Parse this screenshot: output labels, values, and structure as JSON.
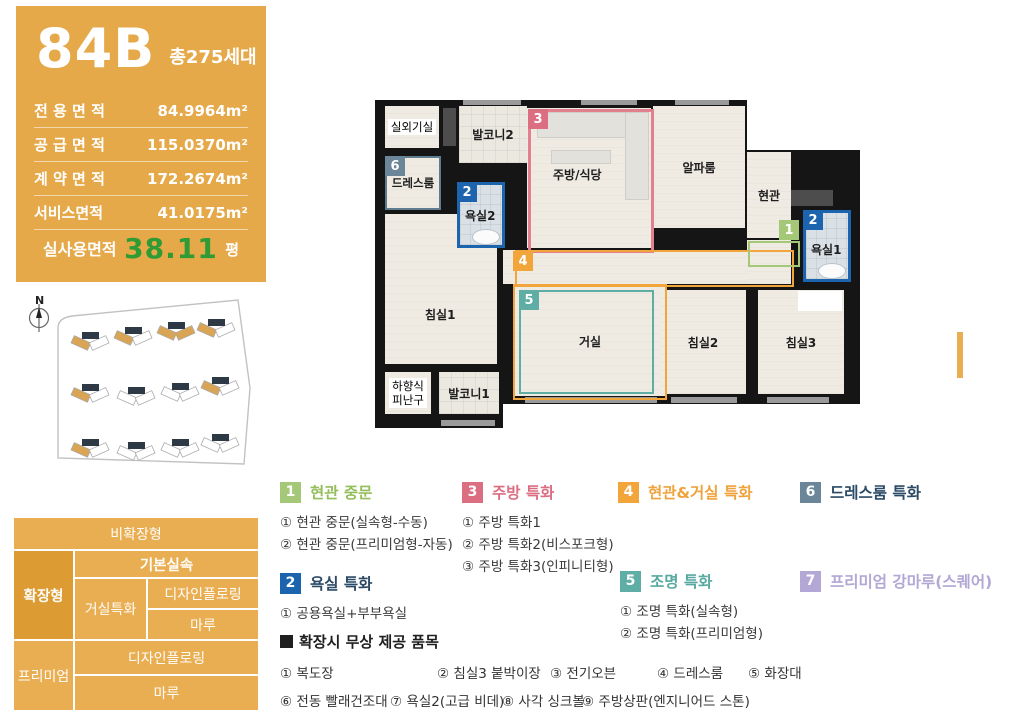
{
  "colors": {
    "panel_orange": "#E5A94A",
    "table_orange": "#EAAE52",
    "table_orange_dark": "#DC9B33",
    "value_green": "#2E9B35",
    "badge_green": "#A5C878",
    "badge_blue": "#1D64AE",
    "badge_pink": "#DC6E81",
    "badge_orange": "#F2A53B",
    "badge_teal": "#5FAEA6",
    "badge_slate": "#6B8698",
    "badge_purple": "#B2A7D5",
    "outline_pink": "#E28090",
    "outline_green": "#A5C878",
    "outline_slate": "#5E7C8E",
    "building_highlight": "#D9A554"
  },
  "unit_panel": {
    "type_code": "84B",
    "total_households": "총275세대",
    "areas": [
      {
        "label": "전 용 면 적",
        "value": "84.9964m²"
      },
      {
        "label": "공 급 면 적",
        "value": "115.0370m²"
      },
      {
        "label": "계 약 면 적",
        "value": "172.2674m²"
      },
      {
        "label": "서비스면적",
        "value": "41.0175m²"
      }
    ],
    "actual_use": {
      "label": "실사용면적",
      "value": "38.11",
      "unit": "평"
    }
  },
  "site_plan": {
    "compass_label": "N"
  },
  "options_table": {
    "non_expanded": "비확장형",
    "expanded": "확장형",
    "basic": "기본실속",
    "living": "거실특화",
    "design_flooring_a": "디자인플로링",
    "maru_a": "마루",
    "premium": "프리미엄",
    "design_flooring_b": "디자인플로링",
    "maru_b": "마루"
  },
  "floorplan": {
    "rooms": {
      "outdoor_unit": "실외기실",
      "balcony2": "발코니2",
      "kitchen": "주방/식당",
      "alpha": "알파룸",
      "entrance": "현관",
      "bath1": "욕실1",
      "dress": "드레스룸",
      "bath2": "욕실2",
      "bed1": "침실1",
      "living": "거실",
      "bed2": "침실2",
      "bed3": "침실3",
      "escape": "하향식\n피난구",
      "balcony1": "발코니1"
    },
    "badges": {
      "entrance_door": "1",
      "bath1": "2",
      "bath2": "2",
      "kitchen": "3",
      "corridor": "4",
      "living": "5",
      "dress": "6"
    }
  },
  "legend": {
    "features": [
      {
        "num": "1",
        "title": "현관 중문",
        "badge_color": "#A5C878",
        "title_color": "#93BE5C",
        "items": [
          "① 현관 중문(실속형-수동)",
          "② 현관 중문(프리미엄형-자동)"
        ]
      },
      {
        "num": "3",
        "title": "주방 특화",
        "badge_color": "#DC6E81",
        "title_color": "#DB6E82",
        "items": [
          "① 주방 특화1",
          "② 주방 특화2(비스포크형)",
          "③ 주방 특화3(인피니티형)"
        ]
      },
      {
        "num": "4",
        "title": "현관&거실 특화",
        "badge_color": "#F2A53B",
        "title_color": "#F0A33C",
        "items": []
      },
      {
        "num": "6",
        "title": "드레스룸 특화",
        "badge_color": "#6B8698",
        "title_color": "#2B4A66",
        "items": []
      },
      {
        "num": "2",
        "title": "욕실 특화",
        "badge_color": "#1D64AE",
        "title_color": "#2B4A66",
        "items": [
          "① 공용욕실+부부욕실"
        ]
      },
      {
        "num": "5",
        "title": "조명 특화",
        "badge_color": "#5FAEA6",
        "title_color": "#57A9A1",
        "items": [
          "① 조명 특화(실속형)",
          "② 조명 특화(프리미엄형)"
        ]
      },
      {
        "num": "7",
        "title": "프리미엄 강마루(스퀘어)",
        "badge_color": "#B2A7D5",
        "title_color": "#B2A7D5",
        "items": []
      }
    ],
    "free_items": {
      "header": "확장시 무상 제공 품목",
      "row1": [
        "① 복도장",
        "② 침실3 붙박이장",
        "③ 전기오븐",
        "④ 드레스룸",
        "⑤ 화장대"
      ],
      "row2": [
        "⑥ 전동 빨래건조대",
        "⑦ 욕실2(고급 비데)",
        "⑧ 사각 싱크볼",
        "⑨ 주방상판(엔지니어드 스톤)"
      ]
    }
  }
}
